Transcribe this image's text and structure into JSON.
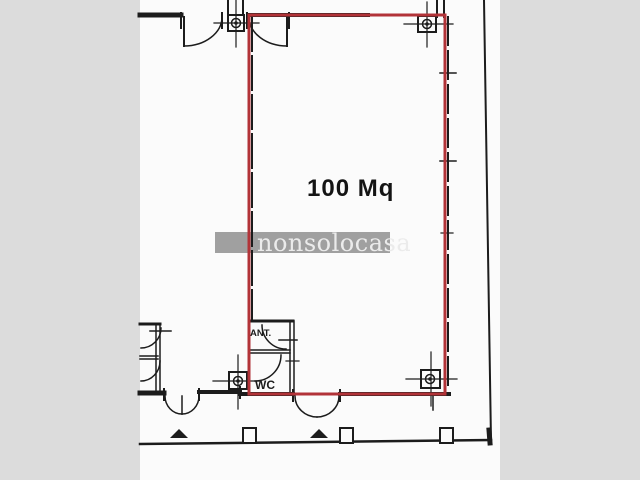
{
  "plan": {
    "area_label": "100 Mq",
    "rooms": {
      "ant_label": "ANT.",
      "wc_label": "WC"
    },
    "watermark_text": "nonsolocasa",
    "colors": {
      "background": "#dcdcdc",
      "paper": "#fbfbfb",
      "line": "#1c1c1c",
      "highlight": "#b23338",
      "watermark_band": "#a0a0a0",
      "watermark_text_color": "#ebebeb"
    }
  }
}
